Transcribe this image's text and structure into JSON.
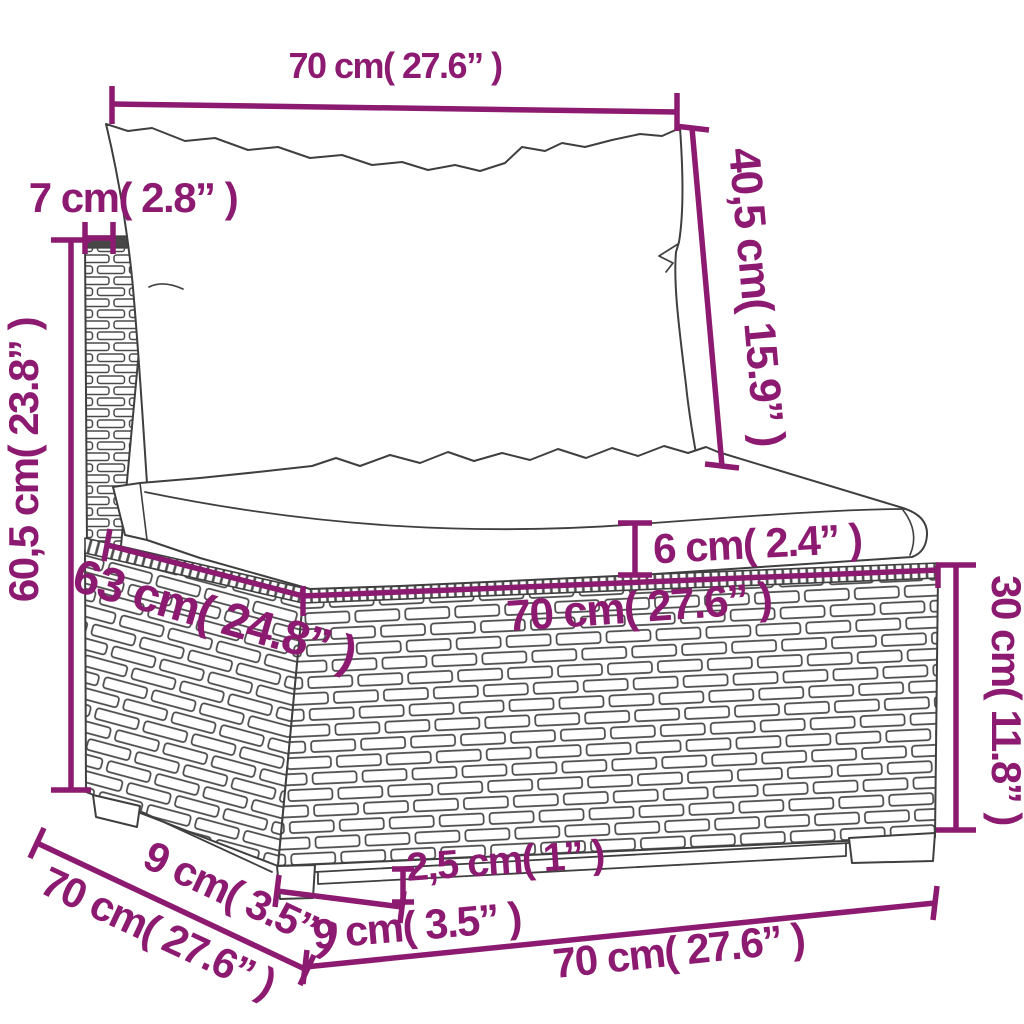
{
  "figure": {
    "kind": "product-dimension-diagram",
    "product": "poly rattan sofa middle section with back pillow and seat cushion"
  },
  "colors": {
    "dimension": "#8C1A70",
    "line_art": "#3f3f3f",
    "background": "#ffffff"
  },
  "dimensions": {
    "back_cushion_width": {
      "text": "70 cm( 27.6” )",
      "value_cm": 70,
      "value_in": 27.6
    },
    "back_panel_thickness": {
      "text": "7 cm( 2.8” )",
      "value_cm": 7,
      "value_in": 2.8
    },
    "back_cushion_height": {
      "text": "40,5 cm( 15.9” )",
      "value_cm": 40.5,
      "value_in": 15.9
    },
    "total_height": {
      "text": "60,5 cm( 23.8” )",
      "value_cm": 60.5,
      "value_in": 23.8
    },
    "seat_inner_depth": {
      "text": "63 cm( 24.8” )",
      "value_cm": 63,
      "value_in": 24.8
    },
    "seat_width": {
      "text": "70 cm( 27.6” )",
      "value_cm": 70,
      "value_in": 27.6
    },
    "seat_cushion_thickness": {
      "text": "6 cm( 2.4” )",
      "value_cm": 6,
      "value_in": 2.4
    },
    "base_height": {
      "text": "30 cm( 11.8” )",
      "value_cm": 30,
      "value_in": 11.8
    },
    "leg_height": {
      "text": "2,5 cm( 1” )",
      "value_cm": 2.5,
      "value_in": 1
    },
    "front_leg_width": {
      "text": "9 cm( 3.5” )",
      "value_cm": 9,
      "value_in": 3.5
    },
    "base_front_width": {
      "text": "70 cm( 27.6” )",
      "value_cm": 70,
      "value_in": 27.6
    },
    "side_leg_width": {
      "text": "9 cm( 3.5” )",
      "value_cm": 9,
      "value_in": 3.5
    },
    "side_depth": {
      "text": "70 cm( 27.6” )",
      "value_cm": 70,
      "value_in": 27.6
    }
  }
}
